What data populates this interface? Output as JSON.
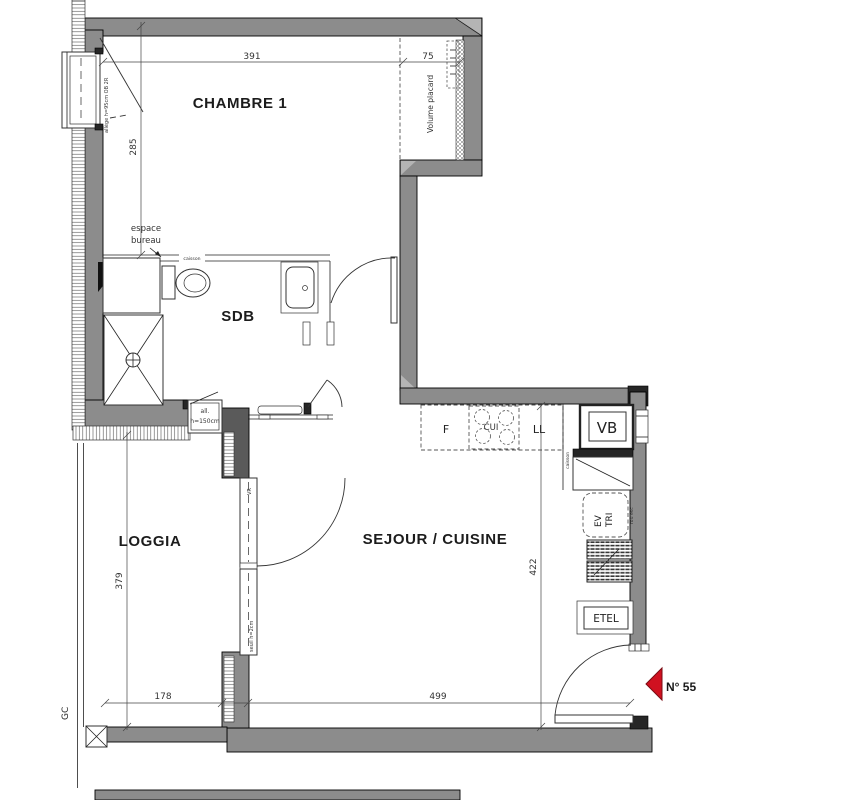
{
  "title": "floor-plan-apartment-55",
  "rooms": {
    "chambre": "CHAMBRE 1",
    "sdb": "SDB",
    "loggia": "LOGGIA",
    "sejour": "SEJOUR / CUISINE"
  },
  "dims": {
    "chambre_w": "391",
    "placard_w": "75",
    "chambre_h": "285",
    "loggia_h": "379",
    "sejour_h": "422",
    "loggia_w": "178",
    "sejour_w": "499"
  },
  "ann": {
    "volume_placard": "Volume placard",
    "espace_l1": "espace",
    "espace_l2": "bureau",
    "caisson_wc": "caisson",
    "allege_chambre": "allège h=95cm OB 2R",
    "all_l1": "all.",
    "all_l2": "h=150cm",
    "vr": "VR",
    "seuil": "seuil h=2cm",
    "gc": "GC",
    "f": "F",
    "cui": "CUI",
    "ll": "LL",
    "vb": "VB",
    "caisson_cuisine": "caisson",
    "ev": "EV",
    "tri": "TRI",
    "duct": "rou esc",
    "etel": "ETEL",
    "unit_no": "N° 55"
  },
  "colors": {
    "wall": "#8c8c8c",
    "wall_dark": "#262626",
    "marker_red": "#d01120",
    "line": "#222222"
  }
}
